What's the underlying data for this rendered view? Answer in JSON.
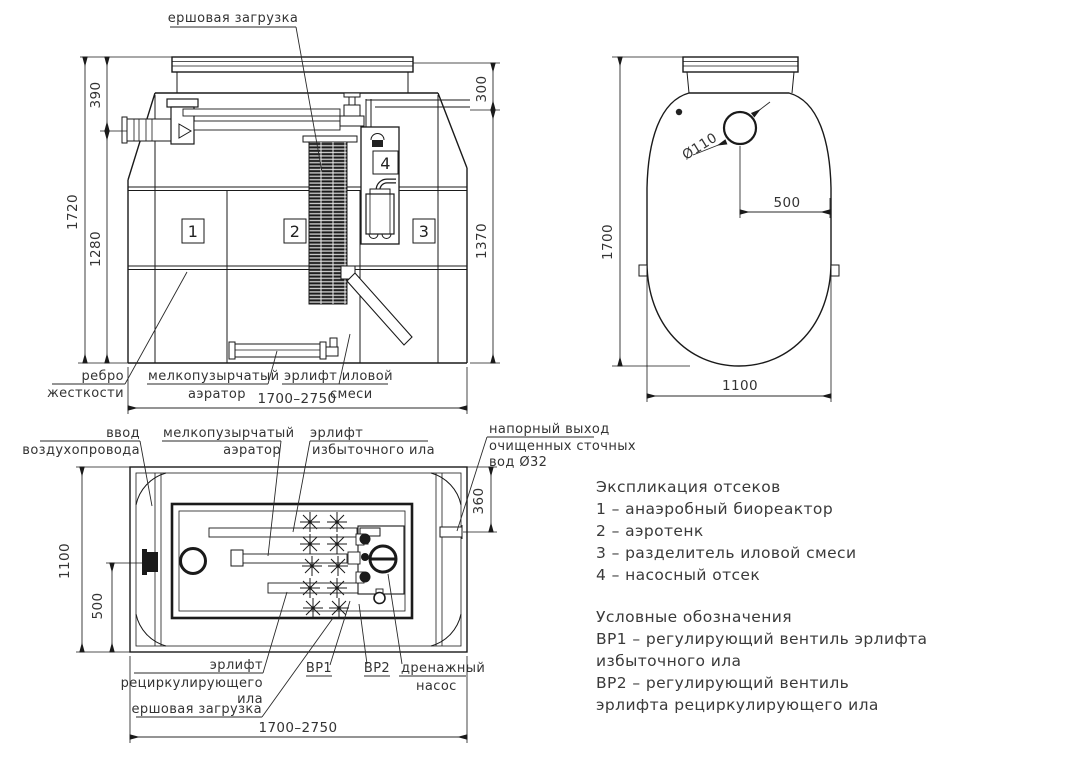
{
  "front_view": {
    "top_label": "ершовая загрузка",
    "dim_1720": "1720",
    "dim_390": "390",
    "dim_1280": "1280",
    "dim_300": "300",
    "dim_1370": "1370",
    "dim_width": "1700–2750",
    "comp_1": "1",
    "comp_2": "2",
    "comp_3": "3",
    "comp_4": "4",
    "label_rib_1": "ребро",
    "label_rib_2": "жесткости",
    "label_aerator_1": "мелкопузырчатый",
    "label_aerator_2": "аэратор",
    "label_airlift_1": "эрлифт иловой",
    "label_airlift_2": "смеси"
  },
  "side_view": {
    "dim_1700": "1700",
    "dim_hole": "Ø110",
    "dim_500": "500",
    "dim_1100": "1100"
  },
  "plan_view": {
    "dim_1100": "1100",
    "dim_500": "500",
    "dim_360": "360",
    "dim_width": "1700–2750",
    "label_air_inlet_1": "ввод",
    "label_air_inlet_2": "воздухопровода",
    "label_aerator_1": "мелкопузырчатый",
    "label_aerator_2": "аэратор",
    "label_excess_airlift_1": "эрлифт",
    "label_excess_airlift_2": "избыточного ила",
    "label_outlet_1": "напорный выход",
    "label_outlet_2": "очищенных сточных",
    "label_outlet_3": "вод Ø32",
    "label_recirc_airlift_1": "эрлифт",
    "label_recirc_airlift_2": "рециркулирующего",
    "label_recirc_airlift_3": "ила",
    "label_brush": "ершовая загрузка",
    "label_vr1": "ВР1",
    "label_vr2": "ВР2",
    "label_drain_pump_1": "дренажный",
    "label_drain_pump_2": "насос"
  },
  "legend": {
    "title": "Экспликация отсеков",
    "item_1": "1 –  анаэробный биореактор",
    "item_2": "2 –  аэротенк",
    "item_3": "3 –  разделитель иловой смеси",
    "item_4": "4 –  насосный отсек",
    "symbols_title": "Условные обозначения",
    "vr1_line1": "ВР1 –  регулирующий вентиль эрлифта",
    "vr1_line2": "избыточного ила",
    "vr2_line1": "ВР2 –  регулирующий вентиль",
    "vr2_line2": "эрлифта рециркулирующего ила"
  }
}
